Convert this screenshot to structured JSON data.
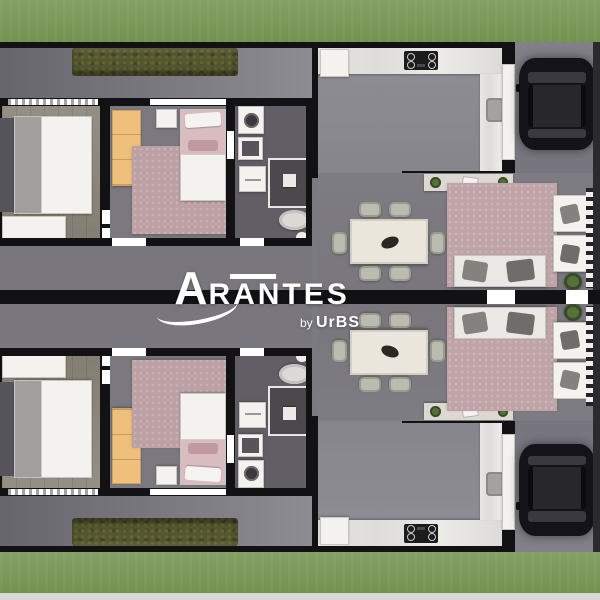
{
  "watermark": {
    "brand": "ARANTES",
    "byline_prefix": "by",
    "byline_brand": "UrBS"
  },
  "palette": {
    "grass": "#84a064",
    "grassLow": "#75914f",
    "grassEdge": "#d8d9d5",
    "wall": "#121114",
    "pave": "#7b7a80",
    "paveDark": "#67666c",
    "hedge": "#50582f",
    "hedgeSpot": "#6d6134",
    "hedgeDark": "#3e4626",
    "wood": "#8e887c",
    "floorBed2": "#7b797f",
    "floorBath": "#615f65",
    "floorKitchen": "#8f8e94",
    "floorLiving": "#79777d",
    "floorGarage": "#82818a",
    "appliance": "#f3f2ef",
    "applianceBorder": "#c7c5c0",
    "wardrobe": "#eec07c",
    "rugPink": "#bca0a3",
    "bedPink": "#d9bcc0",
    "bedAccent": "#c19aa0",
    "headboard": "#56545b",
    "throw": "#a19f9b",
    "sofa": "#eae8e3",
    "cushion": "#84827f",
    "chair": "#b9bcae",
    "chairBorder": "#999c8d",
    "table": "#eae6db",
    "tableBorder": "#d3cfc2",
    "car": "#141317",
    "carRoof": "#28272b",
    "shower": "#4b494e",
    "drum": "#3a383c",
    "plant": "#55713c",
    "plantDark": "#394c28",
    "rightWall": "#2b2a2e"
  }
}
